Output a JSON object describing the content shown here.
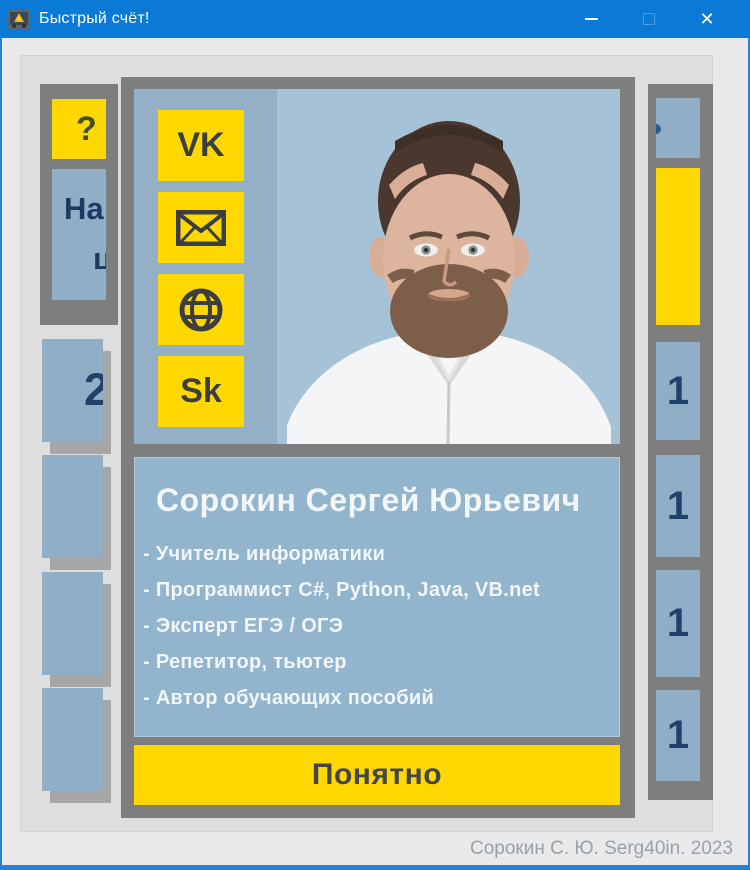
{
  "titlebar": {
    "title": "Быстрый счёт!",
    "close_glyph": "✕"
  },
  "background": {
    "help_button": "?",
    "partial_label_line1": "На",
    "partial_label_line2": "ц",
    "left_cells": [
      {
        "label": "2"
      },
      {
        "label": ""
      },
      {
        "label": ""
      },
      {
        "label": ""
      }
    ],
    "right_cells": [
      {
        "label": "1"
      },
      {
        "label": "1"
      },
      {
        "label": "1"
      },
      {
        "label": "1"
      }
    ]
  },
  "dialog": {
    "link_buttons": {
      "vk": "VK",
      "email_icon": "envelope-icon",
      "web_icon": "globe-icon",
      "skype": "Sk"
    },
    "profile": {
      "name": "Сорокин Сергей Юрьевич",
      "items": [
        "- Учитель информатики",
        "- Программист C#, Python, Java, VB.net",
        "- Эксперт ЕГЭ / ОГЭ",
        "- Репетитор, тьютер",
        "- Автор обучающих пособий"
      ]
    },
    "ok_button": "Понятно"
  },
  "statusbar": {
    "credit": "Сорокин С. Ю. Serg40in. 2023"
  },
  "colors": {
    "titlebar_blue": "#0b7ad7",
    "window_border_blue": "#2183da",
    "accent_yellow": "#ffd802",
    "cell_blue": "#90aec6",
    "frame_gray": "#7e7e7e",
    "navy_text": "#21416b",
    "white_text": "#f2f6f8",
    "dark_text": "#43474a",
    "credit_gray": "#99a1ab"
  }
}
